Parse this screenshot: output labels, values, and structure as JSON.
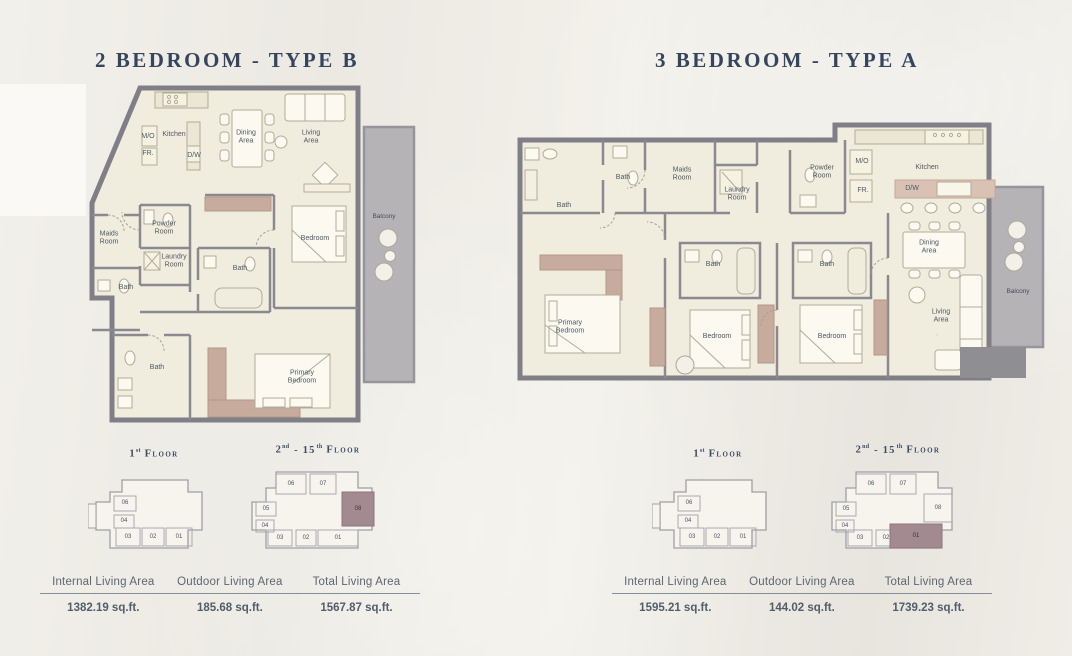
{
  "titles": {
    "left": "2 BEDROOM - TYPE B",
    "right": "3 BEDROOM - TYPE A"
  },
  "floors": {
    "first": {
      "num": "1",
      "sup": "st",
      "word": "Floor"
    },
    "upper": {
      "num": "2",
      "sup": "nd",
      "mid": "- 15",
      "sup2": "th",
      "word": "Floor"
    }
  },
  "colors": {
    "accent_navy": "#36455e",
    "wall_gray": "#807e86",
    "room_cream": "#f1edde",
    "mauve_accent": "#c7ab9d",
    "keyplan_highlight": "#a28a90",
    "balcony_gray": "#b6b3b6"
  },
  "planB": {
    "labels": {
      "mo": "M/O",
      "kitchen": "Kitchen",
      "fr": "FR.",
      "dw": "D/W",
      "dining": "Dining Area",
      "living": "Living Area",
      "maids": "Maids Room",
      "powder": "Powder Room",
      "laundry": "Laundry Room",
      "bath1": "Bath",
      "bath2": "Bath",
      "bath3": "Bath",
      "bedroom": "Bedroom",
      "primary": "Primary Bedroom",
      "balcony": "Balcony"
    },
    "keyplan_first_units": [
      "06",
      "04",
      "03",
      "02",
      "01"
    ],
    "keyplan_upper_units": [
      "06",
      "07",
      "05",
      "04",
      "08",
      "03",
      "02",
      "01"
    ],
    "highlighted_unit": "08",
    "stats": [
      {
        "label": "Internal Living Area",
        "value": "1382.19 sq.ft."
      },
      {
        "label": "Outdoor Living Area",
        "value": "185.68 sq.ft."
      },
      {
        "label": "Total Living Area",
        "value": "1567.87 sq.ft."
      }
    ]
  },
  "planA": {
    "labels": {
      "bath_l": "Bath",
      "bath_s": "Bath",
      "maids": "Maids Room",
      "laundry": "Laundry Room",
      "powder": "Powder Room",
      "mo": "M/O",
      "fr": "FR.",
      "kitchen": "Kitchen",
      "dw": "D/W",
      "dining": "Dining Area",
      "primary": "Primary Bedroom",
      "bath_m": "Bath",
      "bedroom2": "Bedroom",
      "bath_r": "Bath",
      "bedroom3": "Bedroom",
      "living": "Living Area",
      "balcony": "Balcony"
    },
    "keyplan_first_units": [
      "06",
      "04",
      "03",
      "02",
      "01"
    ],
    "keyplan_upper_units": [
      "06",
      "07",
      "05",
      "04",
      "08",
      "03",
      "02",
      "01"
    ],
    "highlighted_unit": "01",
    "stats": [
      {
        "label": "Internal Living Area",
        "value": "1595.21 sq.ft."
      },
      {
        "label": "Outdoor Living Area",
        "value": "144.02 sq.ft."
      },
      {
        "label": "Total Living Area",
        "value": "1739.23 sq.ft."
      }
    ]
  }
}
